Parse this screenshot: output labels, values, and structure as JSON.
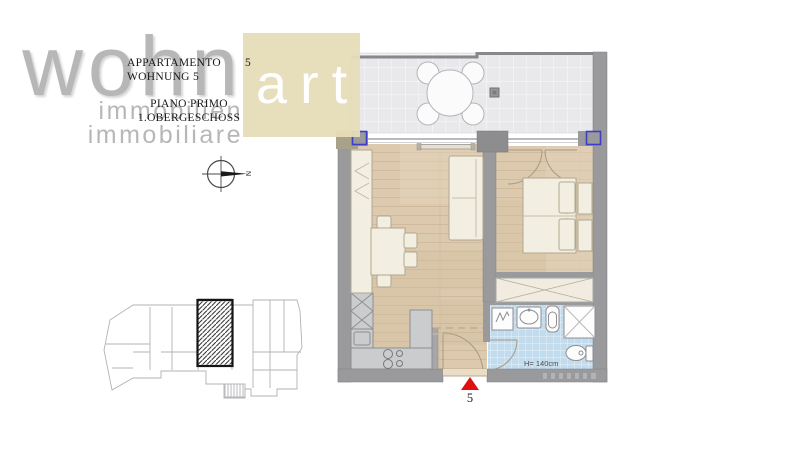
{
  "brand": {
    "logo_gray_text": "wohn",
    "logo_box_text": "art",
    "tagline_line1": "immobilien",
    "tagline_line2": "immobiliare",
    "logo_box_color": "#e7deba",
    "logo_text_color": "#b7b7b7"
  },
  "title_block": {
    "line1_label": "APPARTAMENTO",
    "line1_number": "5",
    "line2": "WOHNUNG 5",
    "line3": "PIANO PRIMO",
    "line4": "1.OBERGESCHOSS"
  },
  "compass": {
    "north_label": "N"
  },
  "floor_plan": {
    "bath_height_label": "H= 140cm",
    "entrance_marker_number": "5",
    "colors": {
      "wall": "#9a9a9c",
      "wall_dark": "#8d8d90",
      "wood_floor": "#dcc9ae",
      "terrace_tile": "#e9e9ec",
      "bathroom_tile": "#c2dcee",
      "furniture": "#f2eee2",
      "kitchen_counter": "#caccce",
      "window_marker": "#3d3dc6",
      "entrance_marker": "#e01010"
    }
  }
}
